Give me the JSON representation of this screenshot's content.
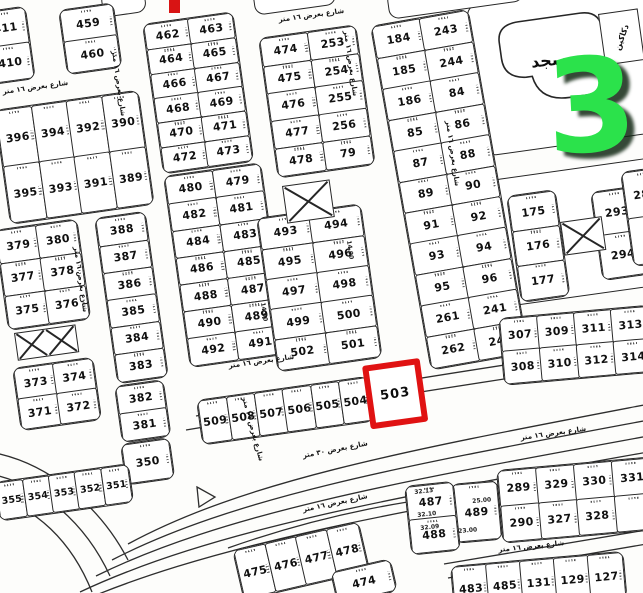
{
  "map": {
    "ink": "#262626",
    "street_label_default": "شارع بعرض ١٦ متر",
    "mosque": {
      "label": "مسجد",
      "x": 488,
      "y": 20,
      "w": 126,
      "h": 112,
      "rot": -8
    },
    "shops": {
      "label": "دكاكين",
      "x": 598,
      "y": 14,
      "w": 38,
      "h": 50,
      "rot": -8,
      "text_rot": -62
    },
    "overlay_number": {
      "text": "3",
      "color": "#2be24b",
      "x": 546,
      "y": 48,
      "size": 130,
      "rot": -3
    },
    "highlight": {
      "label": "503",
      "color": "#e01212",
      "x": 362,
      "y": 366,
      "w": 46,
      "h": 52,
      "rot": -8,
      "border": 6
    },
    "red_marker": {
      "x": 169,
      "y": 0,
      "w": 11,
      "h": 13,
      "color": "#d91414"
    },
    "outlines": [
      {
        "x": 466,
        "y": 6,
        "w": 188,
        "h": 150,
        "rot": -8
      },
      {
        "x": 490,
        "y": 180,
        "w": 162,
        "h": 126,
        "rot": -8
      },
      {
        "x": 100,
        "y": -8,
        "w": 42,
        "h": 24,
        "rot": -8
      },
      {
        "x": 252,
        "y": -10,
        "w": 80,
        "h": 24,
        "rot": -8
      },
      {
        "x": 386,
        "y": -8,
        "w": 134,
        "h": 26,
        "rot": -8
      }
    ],
    "blocks": [
      {
        "name": "blk-411",
        "x": -20,
        "y": 12,
        "w": 42,
        "h": 70,
        "rot": -8,
        "cols": 1,
        "plots": [
          "411",
          "410"
        ]
      },
      {
        "name": "blk-459",
        "x": 58,
        "y": 10,
        "w": 52,
        "h": 62,
        "rot": -8,
        "cols": 1,
        "plots": [
          "459",
          "460"
        ]
      },
      {
        "name": "blk-390",
        "x": -6,
        "y": 110,
        "w": 142,
        "h": 112,
        "rot": -8,
        "cols": 4,
        "plots": [
          "396",
          "394",
          "392",
          "390",
          "395",
          "393",
          "391",
          "389"
        ]
      },
      {
        "name": "blk-380",
        "x": -6,
        "y": 230,
        "w": 80,
        "h": 98,
        "rot": -8,
        "cols": 2,
        "plots": [
          "379",
          "380",
          "377",
          "378",
          "375",
          "376"
        ]
      },
      {
        "name": "blk-372",
        "x": 12,
        "y": 368,
        "w": 78,
        "h": 60,
        "rot": -8,
        "cols": 2,
        "plots": [
          "373",
          "374",
          "371",
          "372"
        ]
      },
      {
        "name": "blk-388",
        "x": 94,
        "y": 218,
        "w": 48,
        "h": 164,
        "rot": -8,
        "cols": 1,
        "plots": [
          "388",
          "387",
          "386",
          "385",
          "384",
          "383"
        ]
      },
      {
        "name": "blk-381",
        "x": 114,
        "y": 386,
        "w": 46,
        "h": 54,
        "rot": -8,
        "cols": 1,
        "plots": [
          "382",
          "381"
        ]
      },
      {
        "name": "blk-350",
        "x": 120,
        "y": 444,
        "w": 46,
        "h": 38,
        "rot": -8,
        "cols": 1,
        "plots": [
          "350"
        ]
      },
      {
        "name": "blk-354",
        "x": -6,
        "y": 482,
        "w": 132,
        "h": 36,
        "rot": -8,
        "cols": 5,
        "plots": [
          "355",
          "354",
          "353",
          "352",
          "351"
        ]
      },
      {
        "name": "blk-462",
        "x": 142,
        "y": 24,
        "w": 88,
        "h": 148,
        "rot": -8,
        "cols": 2,
        "plots": [
          "462",
          "463",
          "464",
          "465",
          "466",
          "467",
          "468",
          "469",
          "470",
          "471",
          "472",
          "473"
        ]
      },
      {
        "name": "blk-480",
        "x": 163,
        "y": 176,
        "w": 95,
        "h": 190,
        "rot": -8,
        "cols": 2,
        "plots": [
          "480",
          "479",
          "482",
          "481",
          "484",
          "483",
          "486",
          "485",
          "488",
          "487",
          "490",
          "489",
          "492",
          "491"
        ]
      },
      {
        "name": "blk-474a",
        "x": 258,
        "y": 38,
        "w": 95,
        "h": 138,
        "rot": -8,
        "cols": 2,
        "plots": [
          "474",
          "253",
          "475",
          "254",
          "476",
          "255",
          "477",
          "256",
          "478",
          "79"
        ]
      },
      {
        "name": "blk-493",
        "x": 256,
        "y": 218,
        "w": 102,
        "h": 152,
        "rot": -8,
        "cols": 2,
        "plots": [
          "493",
          "494",
          "495",
          "496",
          "497",
          "498",
          "499",
          "500",
          "502",
          "501"
        ]
      },
      {
        "name": "blk-184",
        "x": 370,
        "y": 26,
        "w": 96,
        "h": 346,
        "rot": -10,
        "cols": 2,
        "plots": [
          "184",
          "243",
          "185",
          "244",
          "186",
          "84",
          "85",
          "86",
          "87",
          "88",
          "89",
          "90",
          "91",
          "92",
          "93",
          "94",
          "95",
          "96",
          "261",
          "241",
          "262",
          "242"
        ]
      },
      {
        "name": "blk-175",
        "x": 506,
        "y": 196,
        "w": 46,
        "h": 104,
        "rot": -8,
        "cols": 1,
        "plots": [
          "175",
          "176",
          "177"
        ]
      },
      {
        "name": "blk-293",
        "x": 590,
        "y": 192,
        "w": 44,
        "h": 86,
        "rot": -8,
        "cols": 1,
        "plots": [
          "293",
          "294"
        ]
      },
      {
        "name": "blk-284",
        "x": 620,
        "y": 172,
        "w": 40,
        "h": 92,
        "rot": -8,
        "cols": 1,
        "plots": [
          "284",
          "29"
        ]
      },
      {
        "name": "blk-307",
        "x": 498,
        "y": 318,
        "w": 148,
        "h": 64,
        "rot": -5,
        "cols": 4,
        "plots": [
          "307",
          "309",
          "311",
          "313",
          "308",
          "310",
          "312",
          "314"
        ]
      },
      {
        "name": "blk-509",
        "x": 196,
        "y": 400,
        "w": 170,
        "h": 42,
        "rot": -8,
        "cols": 6,
        "plots": [
          "509",
          "508",
          "507",
          "506",
          "505",
          "504"
        ]
      },
      {
        "name": "blk-489",
        "x": 450,
        "y": 484,
        "w": 44,
        "h": 56,
        "rot": -5,
        "cols": 1,
        "plots": [
          "489"
        ]
      },
      {
        "name": "blk-289",
        "x": 496,
        "y": 470,
        "w": 190,
        "h": 70,
        "rot": -5,
        "cols": 5,
        "plots": [
          "289",
          "329",
          "330",
          "331",
          "29",
          "290",
          "327",
          "328",
          "",
          ""
        ]
      },
      {
        "name": "blk-487",
        "x": 404,
        "y": 486,
        "w": 46,
        "h": 66,
        "rot": -6,
        "cols": 1,
        "plots": [
          "487",
          "488"
        ]
      },
      {
        "name": "blk-131",
        "x": 450,
        "y": 566,
        "w": 170,
        "h": 44,
        "rot": -5,
        "cols": 5,
        "plots": [
          "483",
          "485",
          "131",
          "129",
          "127"
        ]
      },
      {
        "name": "blk-475",
        "x": 232,
        "y": 550,
        "w": 126,
        "h": 48,
        "rot": -13,
        "cols": 4,
        "plots": [
          "475",
          "476",
          "477",
          "478"
        ]
      },
      {
        "name": "blk-474b",
        "x": 330,
        "y": 572,
        "w": 58,
        "h": 30,
        "rot": -13,
        "cols": 1,
        "plots": [
          "474"
        ]
      }
    ],
    "xplots": [
      {
        "x": 14,
        "y": 333,
        "w": 60,
        "h": 26,
        "rot": -8,
        "double": true
      },
      {
        "x": 282,
        "y": 186,
        "w": 46,
        "h": 36,
        "rot": -8,
        "double": false
      },
      {
        "x": 560,
        "y": 222,
        "w": 40,
        "h": 32,
        "rot": -8,
        "double": false
      }
    ],
    "street_labels": [
      {
        "x": 278,
        "y": 16,
        "rot": -8
      },
      {
        "x": 350,
        "y": 30,
        "rot": 82
      },
      {
        "x": 452,
        "y": 120,
        "rot": 82
      },
      {
        "x": 118,
        "y": 50,
        "rot": 82
      },
      {
        "x": 2,
        "y": 88,
        "rot": -8
      },
      {
        "x": 80,
        "y": 246,
        "rot": 82
      },
      {
        "x": 228,
        "y": 362,
        "rot": -8
      },
      {
        "x": 248,
        "y": 396,
        "rot": 75
      },
      {
        "x": 302,
        "y": 452,
        "rot": -11,
        "text": "شارع بعرض ٣٠ متر"
      },
      {
        "x": 498,
        "y": 546,
        "rot": -6
      },
      {
        "x": 302,
        "y": 506,
        "rot": -12
      },
      {
        "x": 520,
        "y": 434,
        "rot": -8
      }
    ],
    "dims": [
      {
        "t": "14.00",
        "x": 352,
        "y": 240,
        "rot": 82
      },
      {
        "t": "14.00",
        "x": 266,
        "y": 302,
        "rot": 82
      },
      {
        "t": "25.00",
        "x": 472,
        "y": 498,
        "rot": -5
      },
      {
        "t": "23.00",
        "x": 458,
        "y": 528,
        "rot": -5
      },
      {
        "t": "32.13",
        "x": 414,
        "y": 489,
        "rot": -6
      },
      {
        "t": "32.10",
        "x": 417,
        "y": 512,
        "rot": -6
      },
      {
        "t": "32.09",
        "x": 420,
        "y": 525,
        "rot": -6
      }
    ]
  }
}
